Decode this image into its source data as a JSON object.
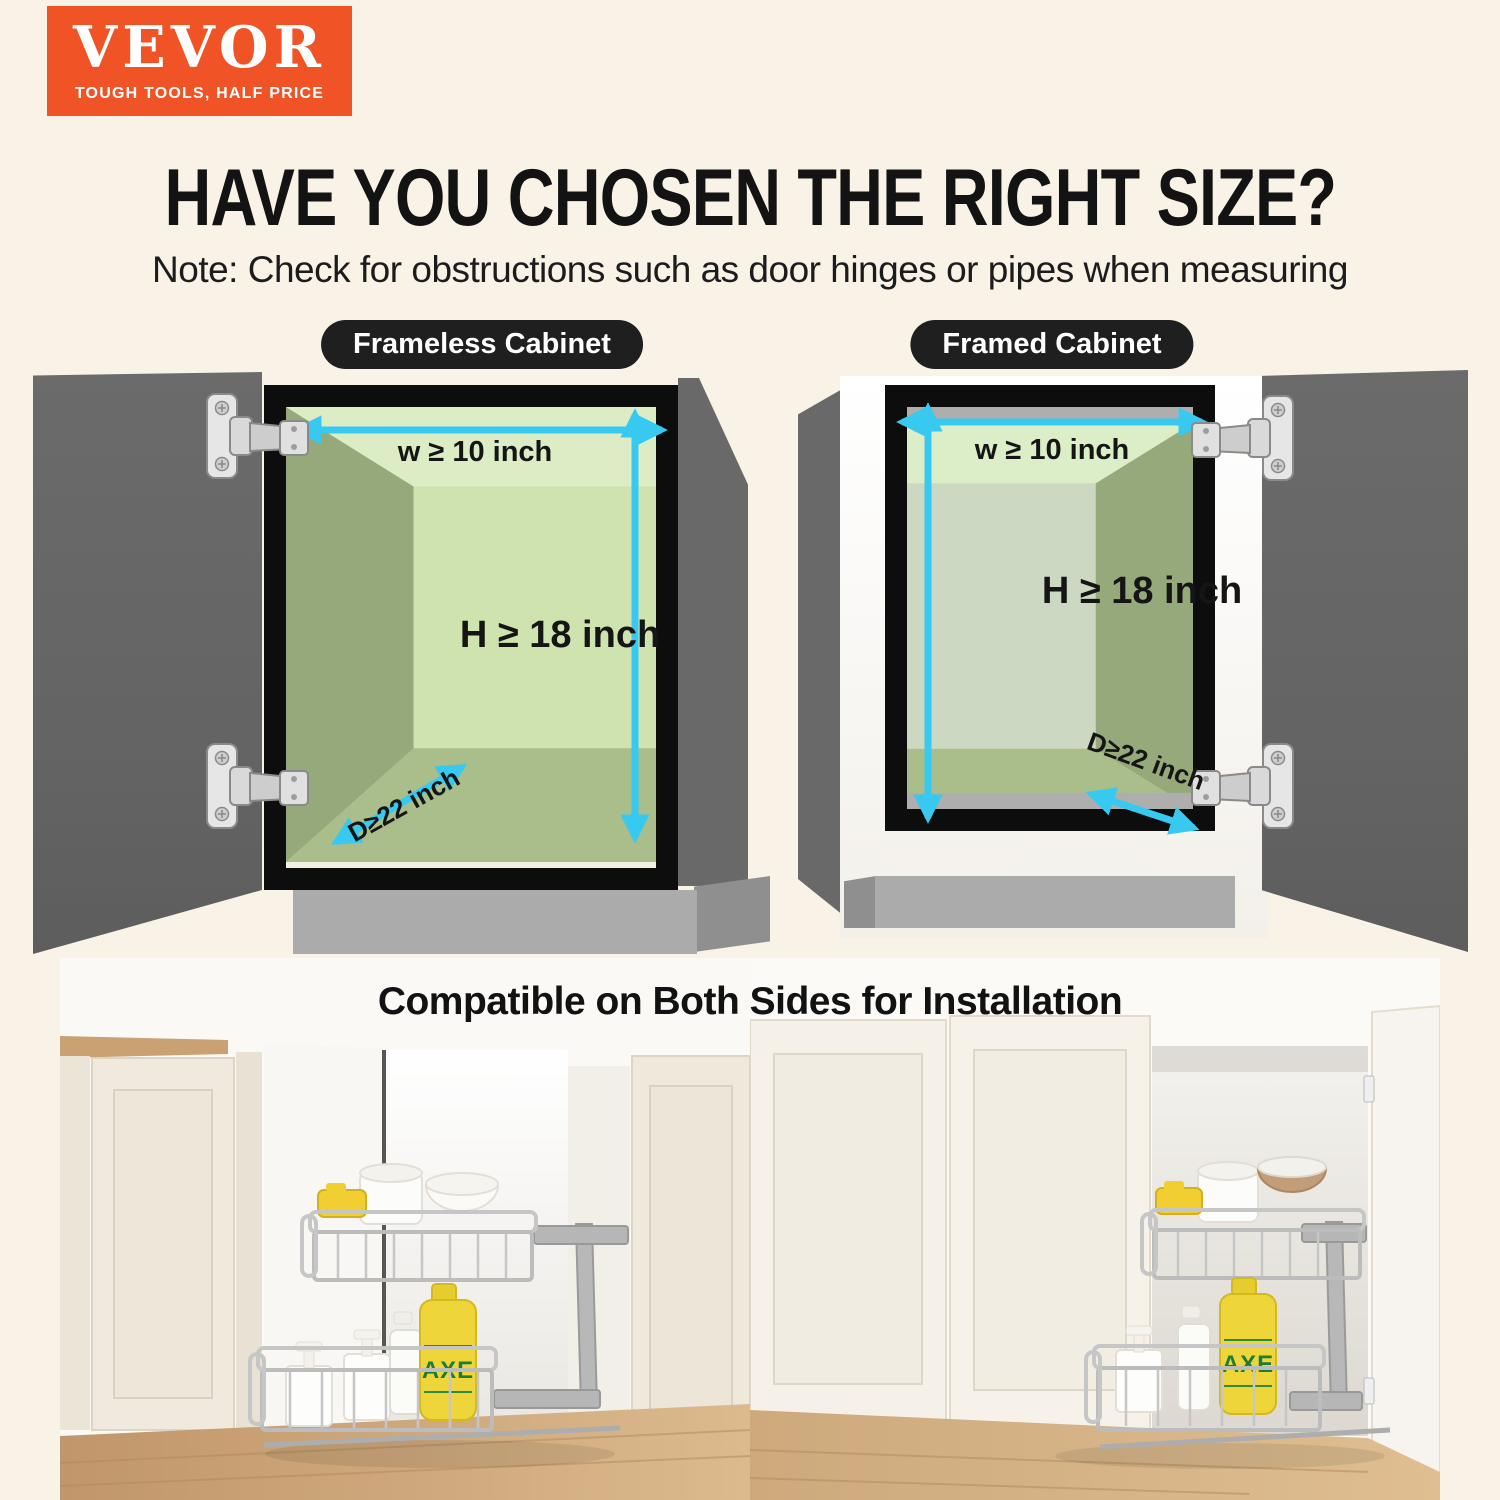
{
  "page": {
    "background": "#f8f2e7",
    "accent_orange": "#f05426",
    "arrow_cyan": "#38c9f0"
  },
  "logo": {
    "brand": "VEVOR",
    "tagline": "TOUGH TOOLS, HALF PRICE"
  },
  "header": {
    "title": "HAVE YOU CHOSEN THE RIGHT SIZE?",
    "note": "Note: Check for obstructions such as door hinges or pipes when measuring"
  },
  "diagrams": {
    "left": {
      "label": "Frameless Cabinet",
      "width_label": "w ≥ 10 inch",
      "height_label": "H ≥ 18 inch",
      "depth_label": "D≥22 inch"
    },
    "right": {
      "label": "Framed Cabinet",
      "width_label": "w ≥ 10 inch",
      "height_label": "H ≥ 18 inch",
      "depth_label": "D≥22 inch"
    }
  },
  "photos": {
    "heading": "Compatible on Both Sides for Installation",
    "bottle_brand": "AXE"
  }
}
